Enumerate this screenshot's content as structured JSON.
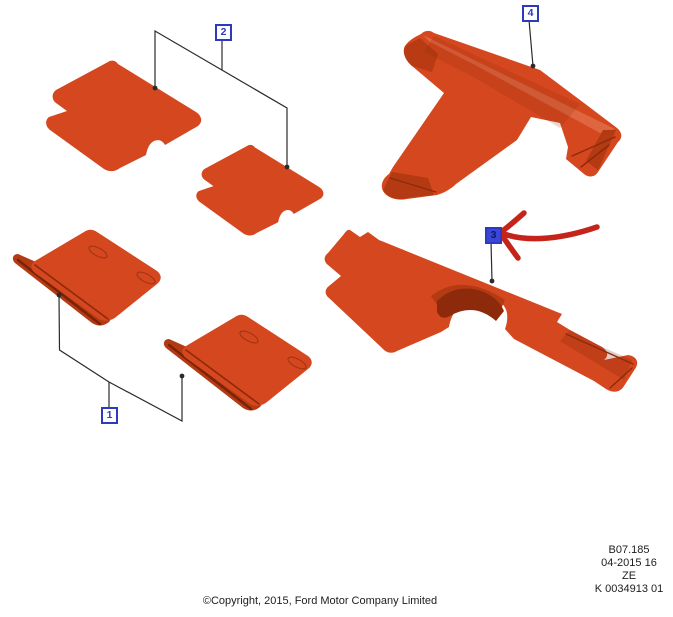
{
  "callouts": [
    {
      "label": "1",
      "style": "outline"
    },
    {
      "label": "2",
      "style": "outline"
    },
    {
      "label": "3",
      "style": "filled-highlighted"
    },
    {
      "label": "4",
      "style": "outline"
    }
  ],
  "annotation": {
    "type": "hand-drawn-red-arrow",
    "points_to_callout": "3"
  },
  "footer": {
    "copyright": "©Copyright, 2015, Ford Motor Company Limited"
  },
  "stamp": {
    "lines": [
      "B07.185",
      "04-2015 16",
      "ZE",
      "K 0034913 01"
    ]
  },
  "colors": {
    "mat_orange": "#d5471e",
    "mat_light": "#e35c2e",
    "mat_mid": "#b33a12",
    "mat_dark": "#8e2a0c",
    "mat_deep": "#7a2206",
    "callout_blue": "#2c3ac0",
    "callout_fill": "#3a46d6",
    "callout_fill_text": "#10166e",
    "arrow_red": "#c5241b",
    "leader": "#2b2b2b",
    "text": "#1d1d1d"
  }
}
